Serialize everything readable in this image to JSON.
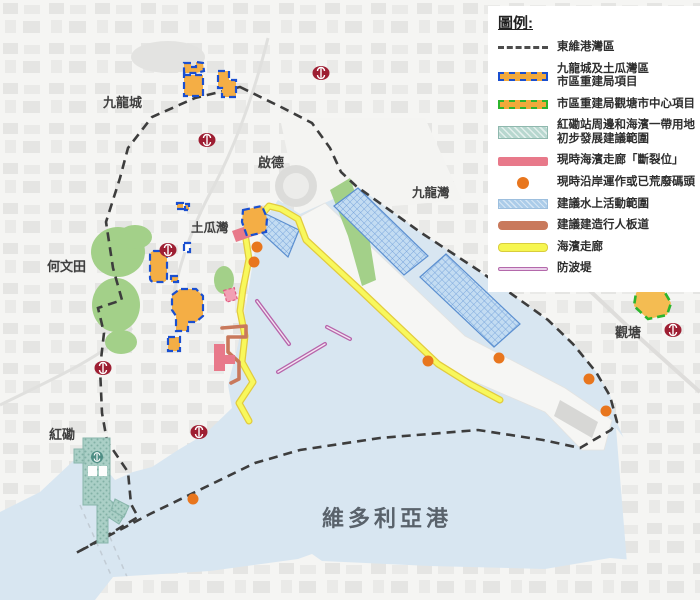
{
  "legend": {
    "title": "圖例:",
    "items": [
      {
        "label": "東維港灣區"
      },
      {
        "label": "九龍城及土瓜灣區\n市區重建局項目"
      },
      {
        "label": "市區重建局觀塘市中心項目"
      },
      {
        "label": "紅磡站周邊和海濱一帶用地\n初步發展建議範圍"
      },
      {
        "label": "現時海濱走廊「斷裂位」"
      },
      {
        "label": "現時沿岸運作或已荒廢碼頭"
      },
      {
        "label": "建議水上活動範圍"
      },
      {
        "label": "建議建造行人板道"
      },
      {
        "label": "海濱走廊"
      },
      {
        "label": "防波堤"
      }
    ]
  },
  "map": {
    "labels": [
      {
        "id": "kowloon-city",
        "text": "九龍城"
      },
      {
        "id": "kai-tak",
        "text": "啟德"
      },
      {
        "id": "to-kwa-wan",
        "text": "土瓜灣"
      },
      {
        "id": "ho-man-tin",
        "text": "何文田"
      },
      {
        "id": "kowloon-bay",
        "text": "九龍灣"
      },
      {
        "id": "kwun-tong",
        "text": "觀塘"
      },
      {
        "id": "hung-hom",
        "text": "紅磡"
      },
      {
        "id": "victoria-harbour",
        "text": "維多利亞港"
      }
    ]
  },
  "colors": {
    "water": "#d8e6f1",
    "land": "#f5f5f3",
    "park_green": "#a3d089",
    "boundary": "#3d3d3d",
    "ura_fill": "#f4ae45",
    "ura_blue_border": "#1a4fd0",
    "ura_green_border": "#2db52d",
    "hunghom_teal": "#aacfc6",
    "break_pink": "#e8798a",
    "pier_orange": "#e8761e",
    "water_activity_blue": "#c3dcf2",
    "boardwalk_brown": "#c9795c",
    "promenade_yellow": "#f8f85c",
    "breakwater_violet": "#b765ab",
    "mtr_red": "#9e1f33"
  }
}
